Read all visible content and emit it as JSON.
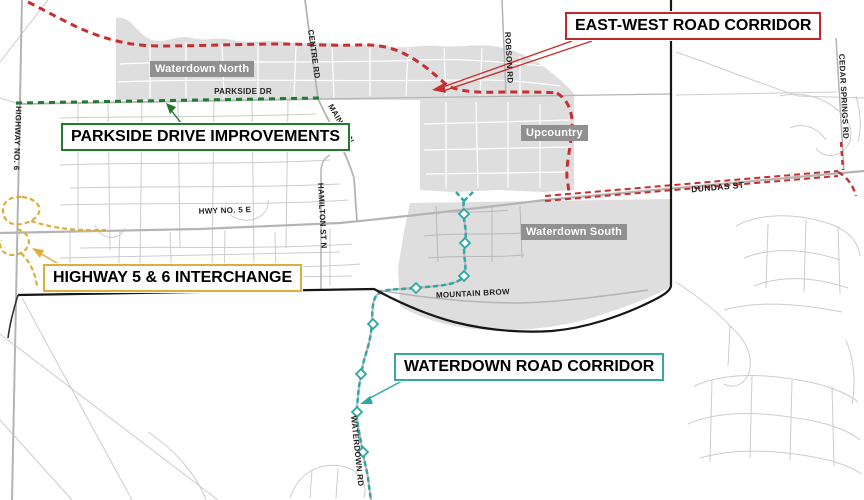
{
  "map": {
    "callouts": {
      "east_west": {
        "label": "EAST-WEST ROAD CORRIDOR",
        "color": "#c0282d"
      },
      "parkside": {
        "label": "PARKSIDE DRIVE IMPROVEMENTS",
        "color": "#217a2e"
      },
      "highway_interchange": {
        "label": "HIGHWAY 5 & 6 INTERCHANGE",
        "color": "#dcaf3c"
      },
      "waterdown": {
        "label": "WATERDOWN ROAD CORRIDOR",
        "color": "#35a8a2"
      }
    },
    "area_labels": {
      "waterdown_north": "Waterdown North",
      "upcountry": "Upcountry",
      "waterdown_south": "Waterdown South"
    },
    "road_labels": {
      "parkside_dr": "PARKSIDE DR",
      "centre_rd": "CENTRE RD",
      "robson_rd": "ROBSON RD",
      "cedar_springs_rd": "CEDAR SPRINGS RD",
      "main_st_n": "MAIN ST N",
      "hamilton_st_n": "HAMILTON ST N",
      "highway_no_6": "HIGHWAY NO. 6",
      "hwy_no_5_e": "HWY NO. 5 E",
      "dundas_st": "DUNDAS ST",
      "mountain_brow": "MOUNTAIN BROW",
      "waterdown_rd": "WATERDOWN RD"
    },
    "legend_colors": {
      "urban_area_fill": "#dedede",
      "boundary_line": "#161616",
      "area_chip_bg": "#909090"
    }
  }
}
